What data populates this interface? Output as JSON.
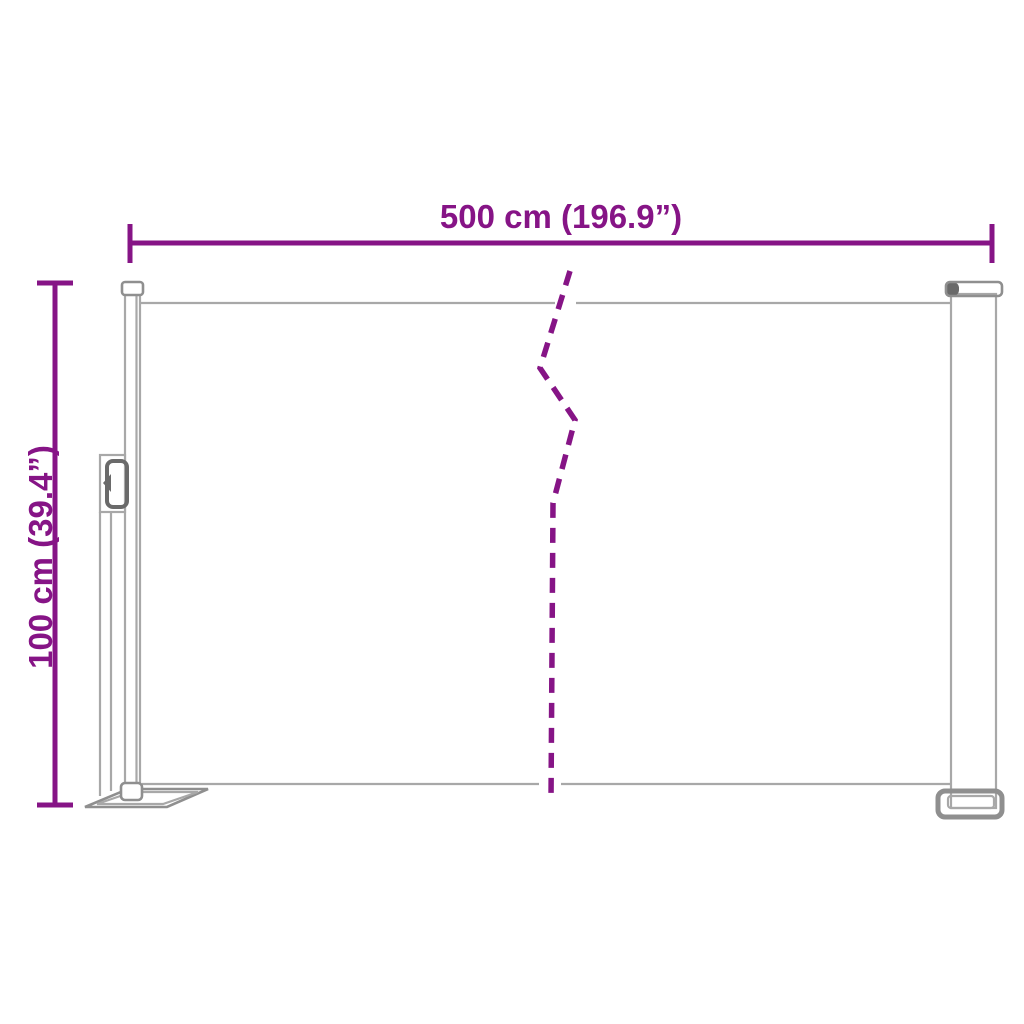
{
  "illustration": "retractable-side-awning-dimension-diagram",
  "dimension_labels": {
    "width": "500 cm (196.9”)",
    "height": "100 cm (39.4”)"
  },
  "colors": {
    "accent": "#861486",
    "line_light": "#a8a8a8",
    "line_medium": "#8f8f8f",
    "line_dark": "#6a6a6a",
    "background": "#ffffff"
  }
}
